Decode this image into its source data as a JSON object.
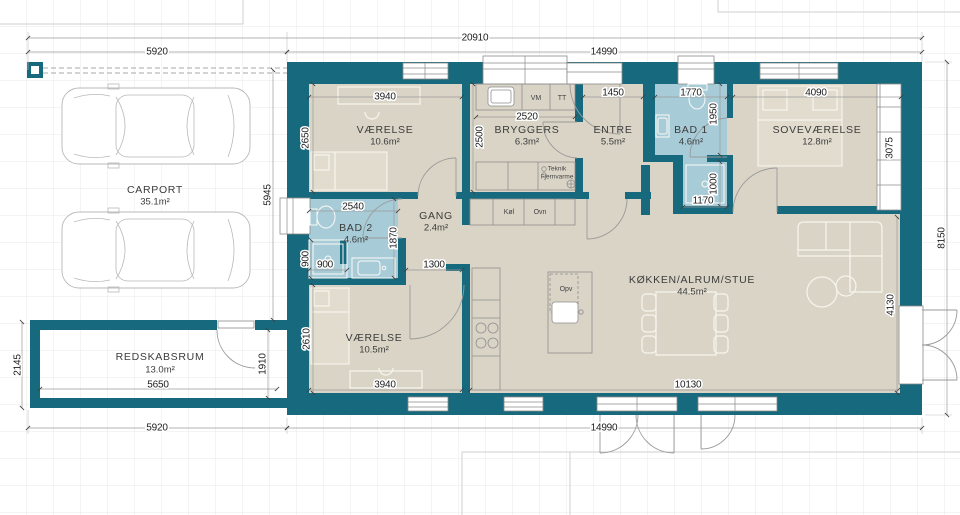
{
  "plan": {
    "rooms": {
      "vaerelse1": {
        "name": "VÆRELSE",
        "area": "10.6m²"
      },
      "bryggers": {
        "name": "BRYGGERS",
        "area": "6.3m²"
      },
      "entre": {
        "name": "ENTRE",
        "area": "5.5m²"
      },
      "bad1": {
        "name": "BAD 1",
        "area": "4.6m²"
      },
      "sovevaerelse": {
        "name": "SOVEVÆRELSE",
        "area": "12.8m²"
      },
      "bad2": {
        "name": "BAD 2",
        "area": "4.6m²"
      },
      "gang": {
        "name": "GANG",
        "area": "2.4m²"
      },
      "koekken": {
        "name": "KØKKEN/ALRUM/STUE",
        "area": "44.5m²"
      },
      "vaerelse2": {
        "name": "VÆRELSE",
        "area": "10.5m²"
      },
      "carport": {
        "name": "CARPORT",
        "area": "35.1m²"
      },
      "redskabsrum": {
        "name": "REDSKABSRUM",
        "area": "13.0m²"
      }
    },
    "appliances": {
      "vm": "VM",
      "tt": "TT",
      "teknik1": "Teknik",
      "teknik2": "Fjernvarme",
      "koel": "Køl",
      "ovn": "Ovn",
      "opv": "Opv"
    },
    "dims": {
      "total": "20910",
      "carport": "5920",
      "house": "14990",
      "carport_depth": "5945",
      "house_depth": "8150",
      "redskab_h": "2145",
      "redskab_inner_h": "1910",
      "redskab_w": "5650",
      "v1_w": "3940",
      "v1_h": "2650",
      "bryggers_w": "2520",
      "bryggers_h": "2500",
      "entre_w": "1450",
      "bad1_w": "1770",
      "bad1_h": "1950",
      "bad1_lower_h": "1000",
      "bad1_lower_w": "1170",
      "sove_w": "4090",
      "wardrobe_h": "3075",
      "bad2_w": "2540",
      "bad2_h": "1870",
      "shower_w": "900",
      "shower_h": "900",
      "gang_w": "1300",
      "v2_h": "2610",
      "v2_w": "3940",
      "kitchen_w": "10130",
      "living_h": "4130"
    },
    "colors": {
      "wall": "#17697d",
      "floor": "#d9d4c6",
      "bath": "#a7ccd8",
      "grid": "#e7eae7"
    }
  }
}
